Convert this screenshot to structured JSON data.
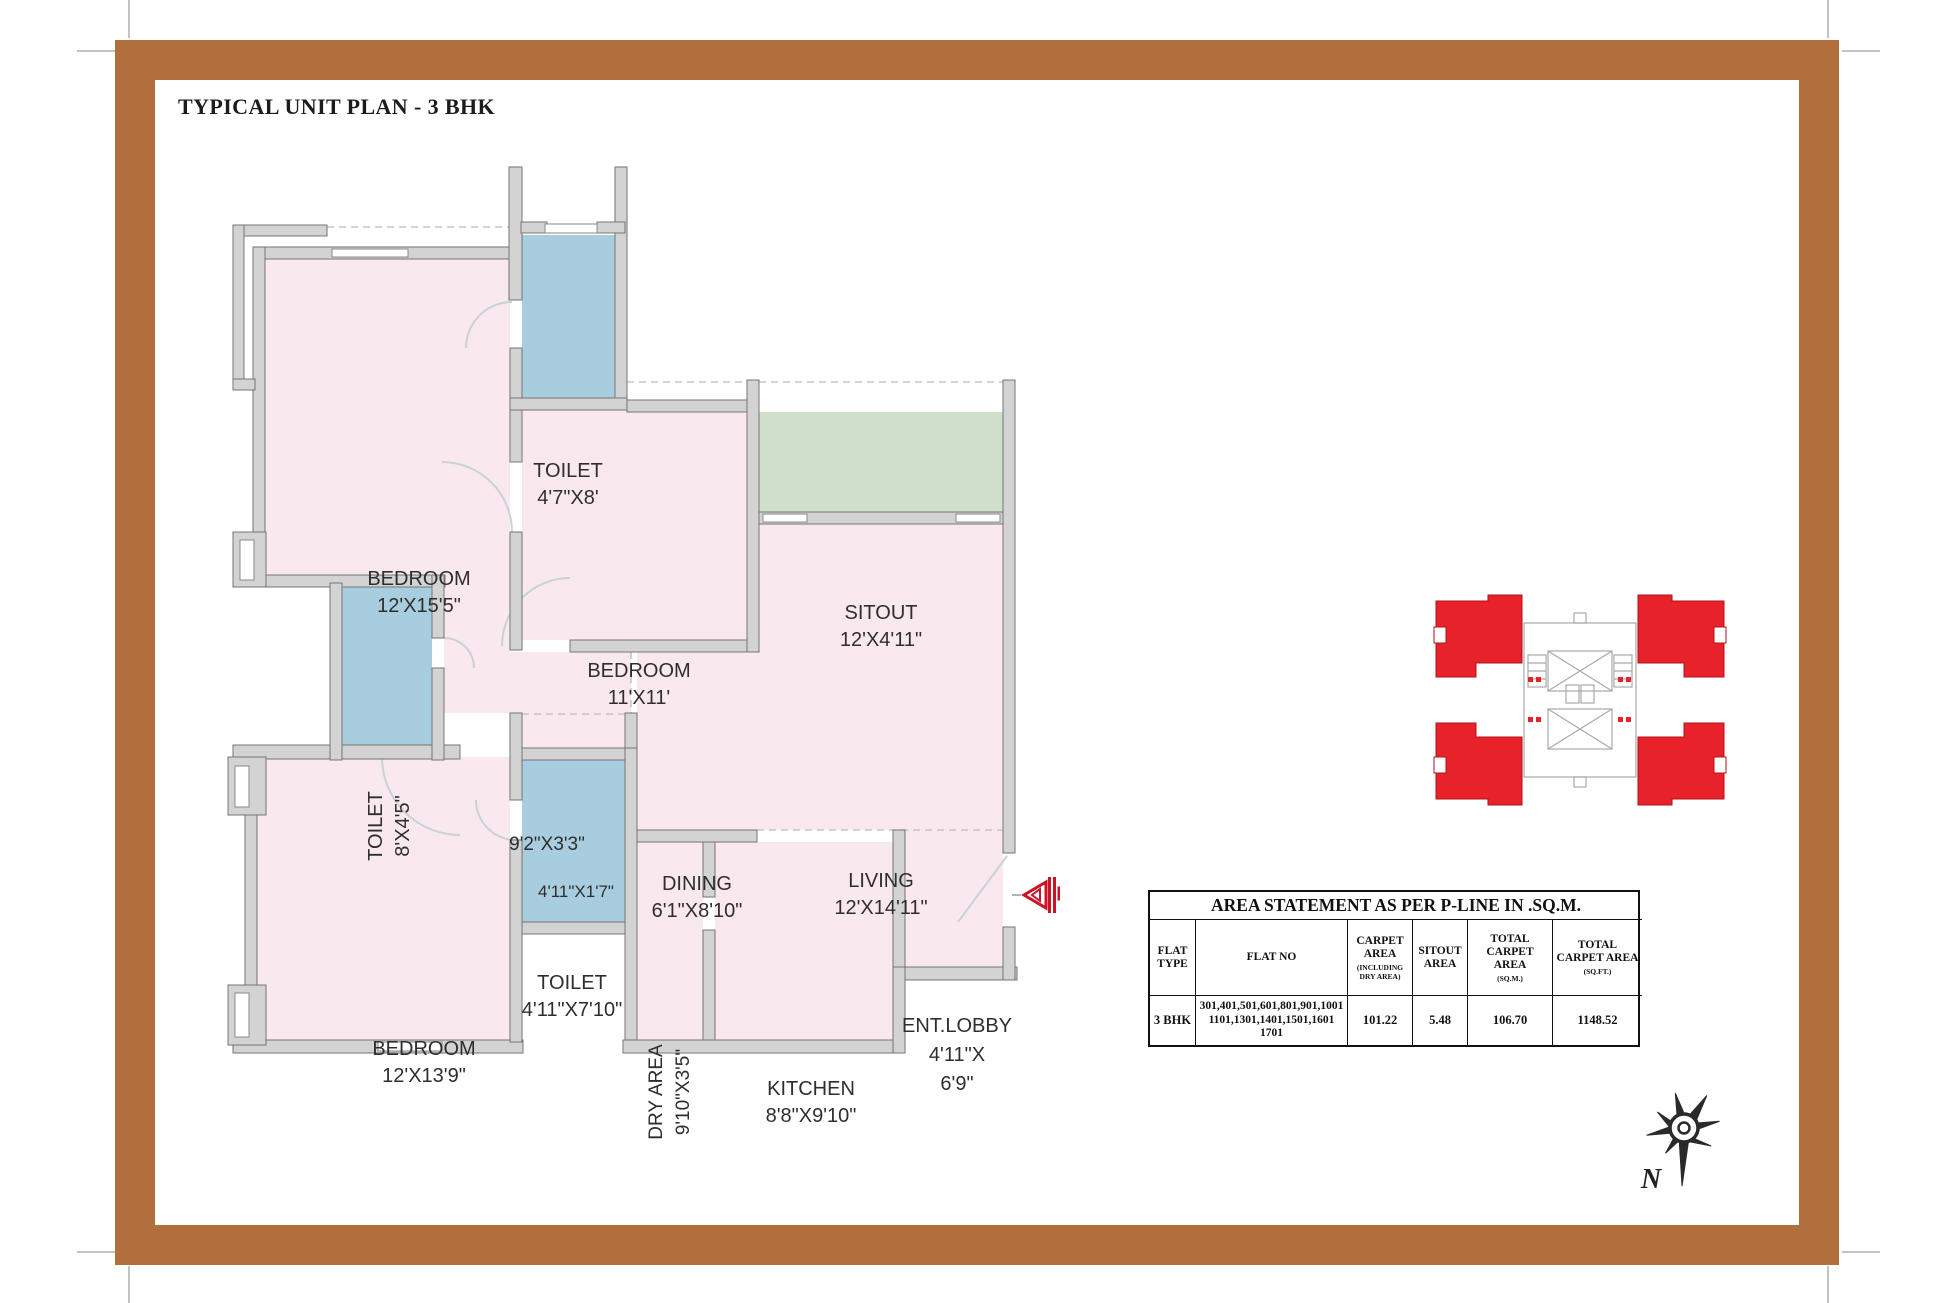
{
  "page_title": "TYPICAL UNIT PLAN - 3 BHK",
  "rooms": {
    "bedroom1": {
      "name": "BEDROOM",
      "dims": "12'X15'5\""
    },
    "toilet1": {
      "name": "TOILET",
      "dims": "4'7\"X8'"
    },
    "bedroom2": {
      "name": "BEDROOM",
      "dims": "11'X11'"
    },
    "sitout": {
      "name": "SITOUT",
      "dims": "12'X4'11\""
    },
    "living": {
      "name": "LIVING",
      "dims": "12'X14'11\""
    },
    "toilet2": {
      "name": "TOILET",
      "dims": "8'X4'5\""
    },
    "passage": {
      "dims": "9'2\"X3'3\""
    },
    "lobby_small": {
      "dims": "4'11\"X1'7\""
    },
    "dining": {
      "name": "DINING",
      "dims": "6'1\"X8'10\""
    },
    "toilet3": {
      "name": "TOILET",
      "dims": "4'11\"X7'10\""
    },
    "bedroom3": {
      "name": "BEDROOM",
      "dims": "12'X13'9\""
    },
    "dry_area": {
      "name": "DRY AREA",
      "dims": "9'10\"X3'5\""
    },
    "kitchen": {
      "name": "KITCHEN",
      "dims": "8'8\"X9'10\""
    },
    "ent_lobby": {
      "name": "ENT.LOBBY",
      "dims_line1": "4'11\"X",
      "dims_line2": "6'9\""
    }
  },
  "area_table": {
    "title": "AREA STATEMENT AS PER P-LINE  IN .SQ.M.",
    "headers": {
      "flat_type": "FLAT TYPE",
      "flat_no": "FLAT NO",
      "carpet_area": "CARPET AREA",
      "carpet_area_note": "(INCLUDING DRY AREA)",
      "sitout_area": "SITOUT AREA",
      "total_sqm": "TOTAL CARPET AREA",
      "total_sqm_note": "(SQ.M.)",
      "total_sqft": "TOTAL CARPET AREA",
      "total_sqft_note": "(SQ.FT.)"
    },
    "row": {
      "flat_type": "3 BHK",
      "flat_no_line1": "301,401,501,601,801,901,1001",
      "flat_no_line2": "1101,1301,1401,1501,1601",
      "flat_no_line3": "1701",
      "carpet_area": "101.22",
      "sitout_area": "5.48",
      "total_sqm": "106.70",
      "total_sqft": "1148.52"
    }
  },
  "compass": {
    "north_label": "N"
  },
  "colors": {
    "frame_brown": "#b06f3c",
    "room_pink": "#f9e8ee",
    "toilet_blue": "#a7cdde",
    "sitout_green": "#cfdfca",
    "wall_gray": "#d3d3d3",
    "keyplan_red": "#e8222a",
    "entrance_marker_red": "#cf1126"
  }
}
